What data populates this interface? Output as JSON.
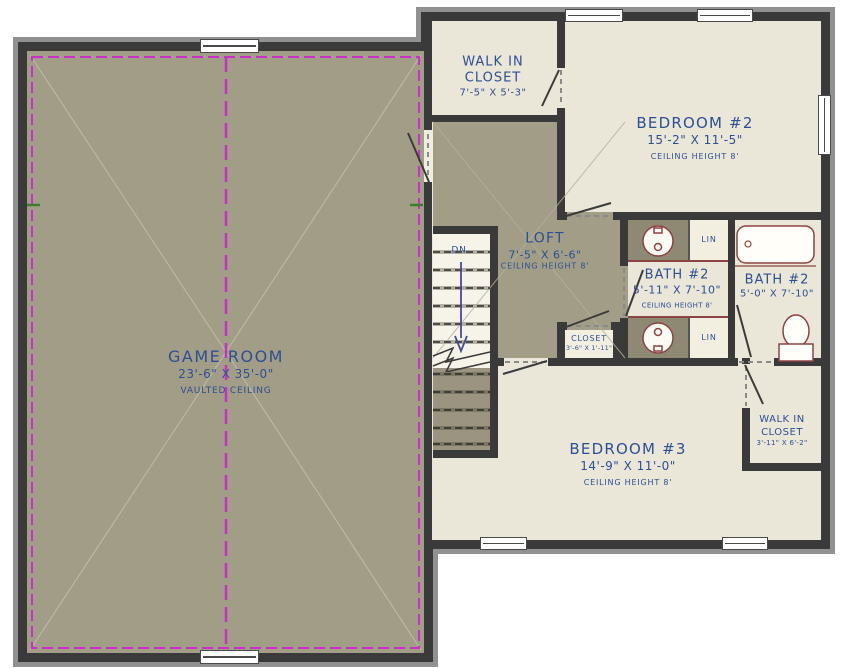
{
  "title": "Second Floor Plan",
  "colors": {
    "wall": "#3a3a3a",
    "wall_shadow": "#919191",
    "floor_olive": "#a29d86",
    "floor_cream": "#eae6d8",
    "floor_lin": "#f3efe0",
    "vanity": "#8e8972",
    "magenta": "#cc2ecc",
    "text_blue": "#2e4f94",
    "fixture_red": "#8d4343",
    "stair_arrow_blue": "#3b4f9b"
  },
  "rooms": {
    "game_room": {
      "name": "GAME ROOM",
      "dims": "23'-6\" X 35'-0\"",
      "note": "VAULTED CEILING"
    },
    "walk_in_closet": {
      "line1": "WALK IN",
      "line2": "CLOSET",
      "dims": "7'-5\" X 5'-3\""
    },
    "bedroom_2": {
      "name": "BEDROOM #2",
      "dims": "15'-2\" X 11'-5\"",
      "note": "CEILING HEIGHT 8'"
    },
    "loft": {
      "name": "LOFT",
      "dims": "7'-5\" X 6'-6\"",
      "note": "CEILING HEIGHT 8'"
    },
    "bath_2": {
      "name": "BATH #2",
      "dims": "5'-11\" X 7'-10\"",
      "note": "CEILING HEIGHT 8'"
    },
    "bath_2b": {
      "name": "BATH #2",
      "dims": "5'-0\" X 7'-10\""
    },
    "hall_closet": {
      "name": "CLOSET",
      "dims": "3'-6\" X 1'-11\""
    },
    "bedroom_3": {
      "name": "BEDROOM #3",
      "dims": "14'-9\" X 11'-0\"",
      "note": "CEILING HEIGHT 8'"
    },
    "walk_in_closet_2": {
      "line1": "WALK IN",
      "line2": "CLOSET",
      "dims": "3'-11\" X 6'-2\""
    }
  },
  "labels": {
    "lin": "LIN",
    "down": "DN"
  }
}
